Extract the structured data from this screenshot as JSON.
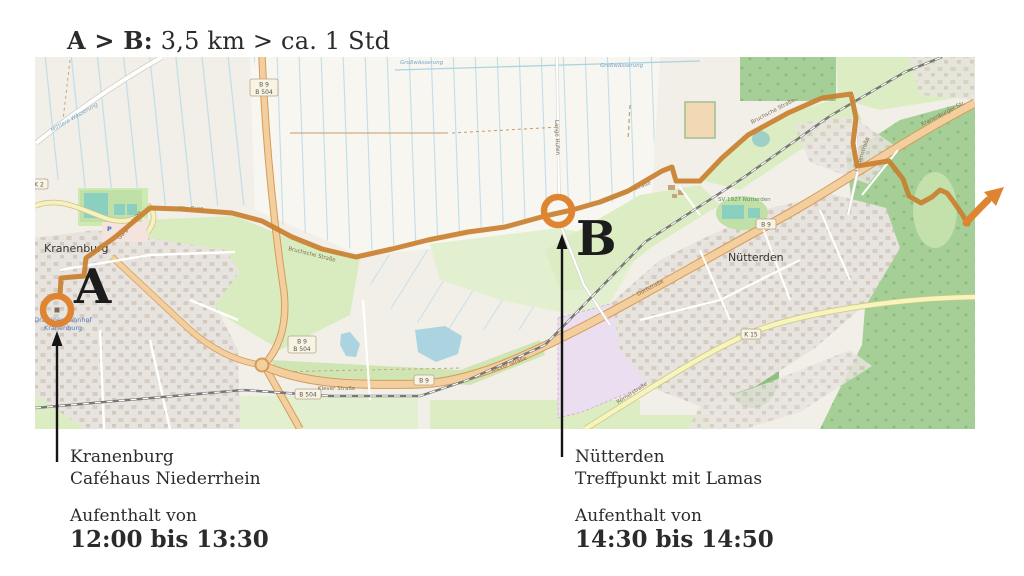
{
  "title": {
    "route_label": "A > B:",
    "distance_duration": "3,5 km > ca. 1 Std"
  },
  "markers": {
    "a": {
      "letter": "A",
      "poi_line1": "Draisinenbahnhof",
      "poi_line2": "Kranenburg"
    },
    "b": {
      "letter": "B"
    }
  },
  "stops": {
    "a": {
      "place": "Kranenburg",
      "detail": "Caféhaus Niederrhein",
      "stay_label": "Aufenthalt von",
      "time_range": "12:00 bis 13:30"
    },
    "b": {
      "place": "Nütterden",
      "detail": "Treffpunkt mit Lamas",
      "stay_label": "Aufenthalt von",
      "time_range": "14:30 bis 14:50"
    }
  },
  "map": {
    "towns": {
      "kranenburg": "Kranenburg",
      "nuetterden": "Nütterden"
    },
    "poi": {
      "sports_club": "SV 1927 Nütterden",
      "parking": "P"
    },
    "roads": {
      "alte_burg": "Alte Burg",
      "bruchsche": "Bruchsche Straße",
      "galgensteeg": "Galgensteeg",
      "lange_hufen": "Lange Hufen",
      "dorfstrasse": "Dorfstraße",
      "klever": "Klever Straße",
      "roemerstrasse": "Römerstraße",
      "lindenstrasse": "Lindenstraße",
      "kranenburger": "Kranenburger Str."
    },
    "waters": {
      "grosswaesserung": "Großwässerung",
      "mittlere": "Mittlere Wässerung"
    },
    "shields": {
      "b9": "B 9",
      "b504": "B 504",
      "k15": "K 15",
      "k2": "K 2"
    },
    "colors": {
      "route": "#c9802f",
      "marker": "#df8531",
      "annotation": "#151515",
      "water": "#abd4e0",
      "meadow": "#d9ecc0",
      "forest": "#a5cf96",
      "road_primary": "#f3cf9f",
      "road_secondary": "#f7f4be",
      "residential": "#e7e3de"
    }
  }
}
